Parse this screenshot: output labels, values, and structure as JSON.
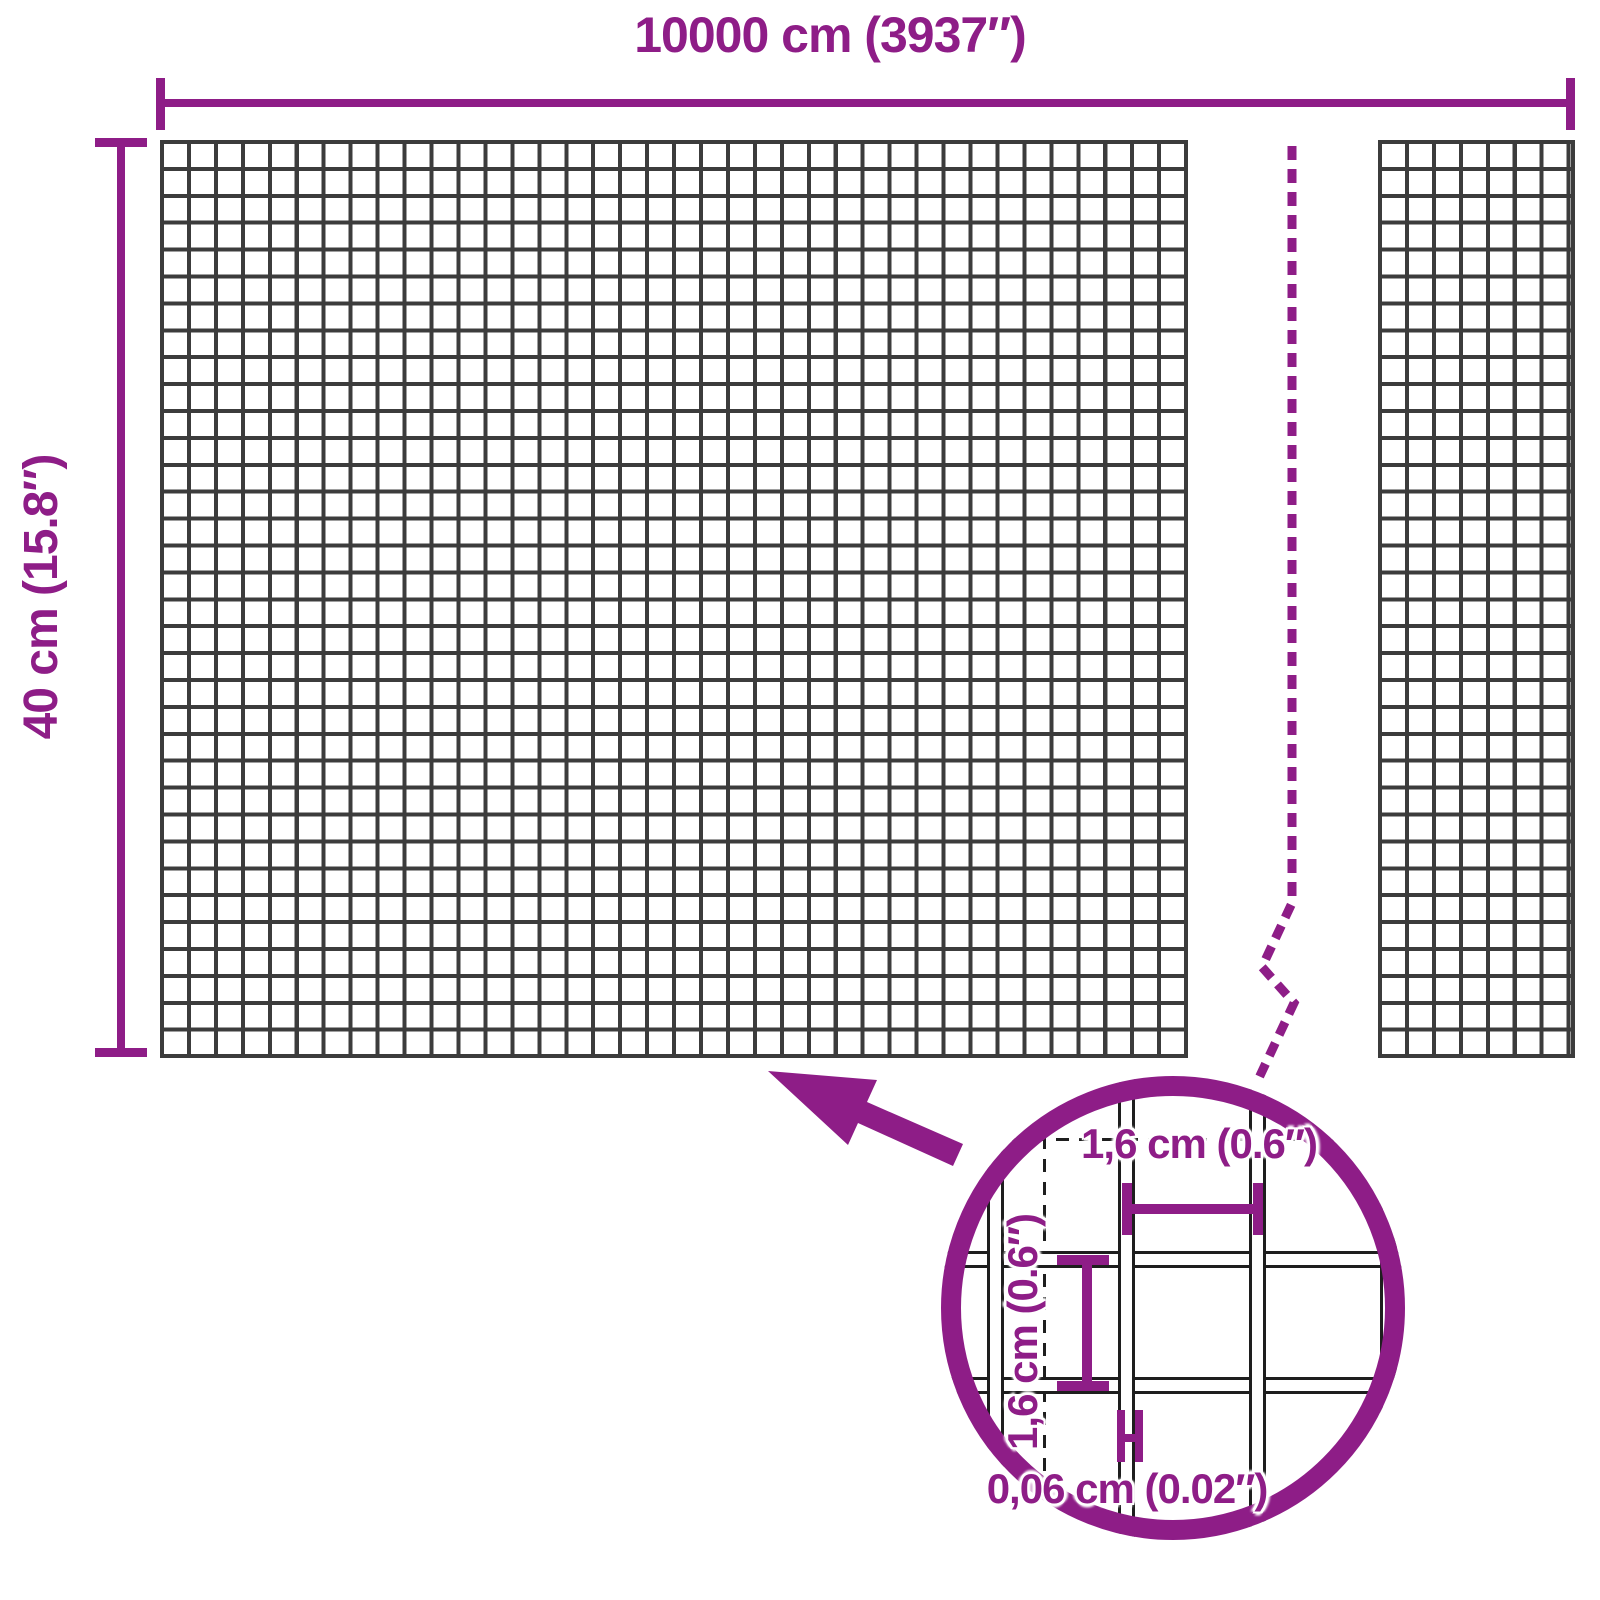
{
  "diagram": {
    "description": "wire mesh roll dimension diagram",
    "colors": {
      "accent": "#8e1d87",
      "mesh_line": "#3c3c3c",
      "wire_outline": "#1e1e1e",
      "background": "#ffffff"
    },
    "labels": {
      "total_width": "10000 cm (3937″)",
      "total_height": "40 cm (15.8″)",
      "mesh_opening_width": "1,6 cm (0.6″)",
      "mesh_opening_height": "1,6 cm (0.6″)",
      "wire_thickness": "0,06 cm (0.02″)"
    }
  }
}
